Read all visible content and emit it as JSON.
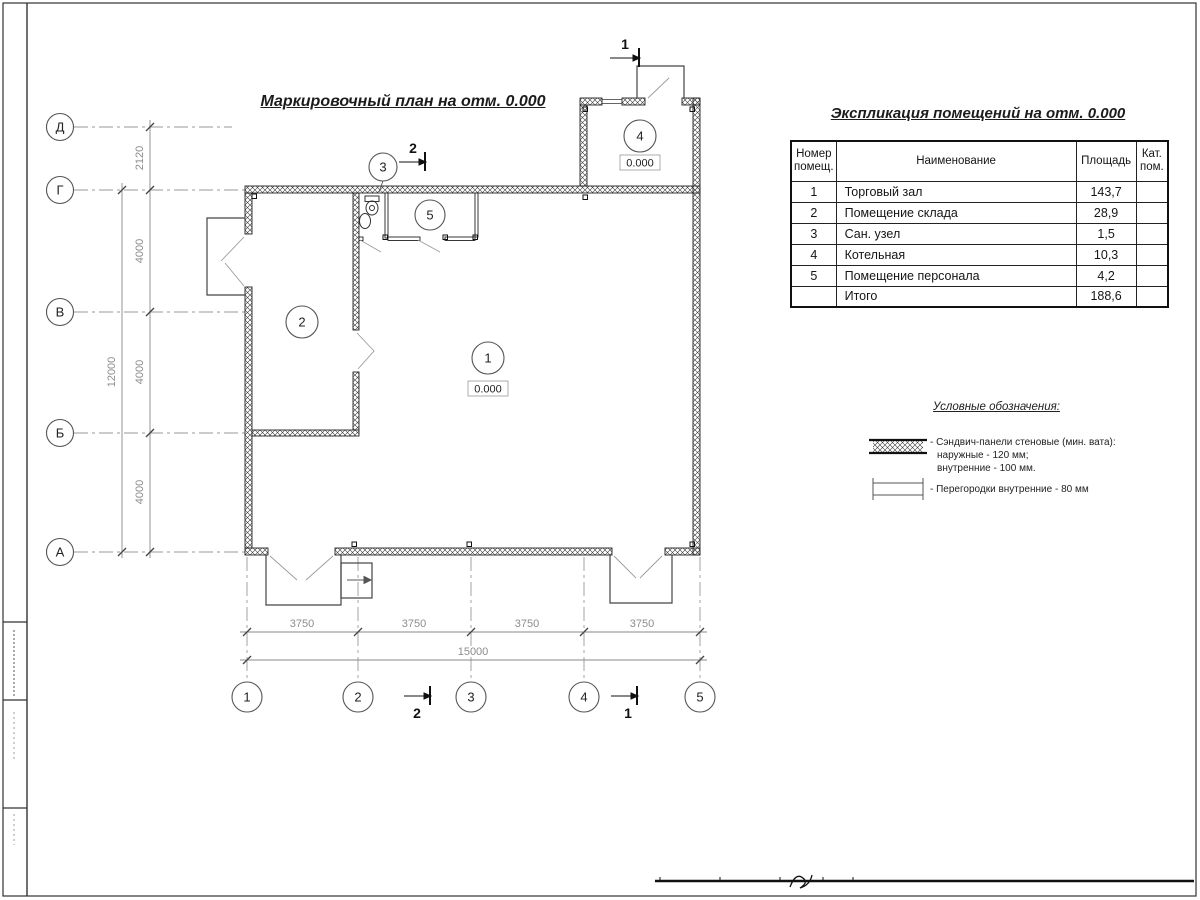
{
  "titles": {
    "plan": "Маркировочный план на отм. 0.000",
    "explication": "Экспликация помещений на отм. 0.000"
  },
  "grid": {
    "vertical_axes": [
      "Д",
      "Г",
      "В",
      "Б",
      "А"
    ],
    "horizontal_axes": [
      "1",
      "2",
      "3",
      "4",
      "5"
    ]
  },
  "dims": {
    "left": [
      "2120",
      "4000",
      "4000",
      "4000"
    ],
    "left_total": "12000",
    "bottom": [
      "3750",
      "3750",
      "3750",
      "3750"
    ],
    "bottom_total": "15000"
  },
  "rooms": [
    "1",
    "2",
    "3",
    "4",
    "5"
  ],
  "levels": {
    "room1": "0.000",
    "room4": "0.000"
  },
  "sections": {
    "top_left": "2",
    "top_right": "1",
    "bottom_left": "2",
    "bottom_right": "1"
  },
  "table": {
    "headers": [
      "Номер помещ.",
      "Наименование",
      "Площадь",
      "Кат. пом."
    ],
    "rows": [
      {
        "n": "1",
        "name": "Торговый зал",
        "area": "143,7",
        "cat": ""
      },
      {
        "n": "2",
        "name": "Помещение склада",
        "area": "28,9",
        "cat": ""
      },
      {
        "n": "3",
        "name": "Сан. узел",
        "area": "1,5",
        "cat": ""
      },
      {
        "n": "4",
        "name": "Котельная",
        "area": "10,3",
        "cat": ""
      },
      {
        "n": "5",
        "name": "Помещение персонала",
        "area": "4,2",
        "cat": ""
      },
      {
        "n": "",
        "name": "Итого",
        "area": "188,6",
        "cat": ""
      }
    ]
  },
  "legend": {
    "title": "Условные обозначения:",
    "item1_line1": "- Сэндвич-панели стеновые (мин. вата):",
    "item1_line2": "наружные - 120 мм;",
    "item1_line3": "внутренние - 100 мм.",
    "item2_line1": "- Перегородки внутренние - 80 мм"
  },
  "colors": {
    "line": "#1c1c1c",
    "dim_text": "#8c8c8c",
    "thin": "#999999"
  }
}
